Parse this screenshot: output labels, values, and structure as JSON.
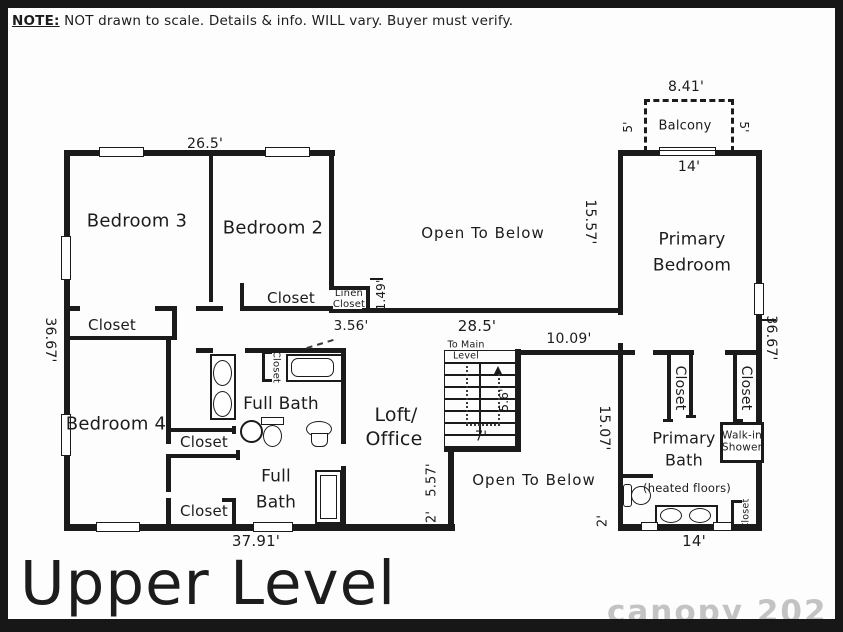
{
  "note": {
    "label": "NOTE:",
    "text": " NOT drawn to scale. Details & info. WILL vary. Buyer must verify."
  },
  "title": "Upper Level",
  "watermark": "canopy 202",
  "rooms": {
    "bedroom3": "Bedroom 3",
    "bedroom2": "Bedroom 2",
    "bedroom2_closet": "Closet",
    "linen_closet": "Linen Closet",
    "hall_closet": "Closet",
    "bedroom4": "Bedroom 4",
    "tub_closet": "Closet",
    "full_bath_upper": "Full Bath",
    "mid_closet": "Closet",
    "full_bath_lower": "Full Bath",
    "lower_closet": "Closet",
    "loft_line1": "Loft/",
    "loft_line2": "Office",
    "open_to_below_upper": "Open To Below",
    "open_to_below_lower": "Open To Below",
    "stairs_note": "To Main Level",
    "balcony": "Balcony",
    "primary_bedroom": "Primary Bedroom",
    "primary_closet_left": "Closet",
    "primary_closet_right": "Closet",
    "walk_in_shower": "Walk-in Shower",
    "primary_bath": "Primary Bath",
    "primary_bath_note": "(heated floors)",
    "primary_bath_closet": "Closet"
  },
  "dimensions": {
    "top_left_width": "26.5'",
    "balcony_width": "8.41'",
    "balcony_depth_left": "5'",
    "balcony_depth_right": "5'",
    "primary_top_width": "14'",
    "open_below_height": "15.57'",
    "linen_depth": "1.49'",
    "linen_width": "3.56'",
    "open_below_width": "28.5'",
    "hall_width": "10.09'",
    "left_height": "36.67'",
    "right_height": "36.67'",
    "stair_run": "5.6'",
    "stair_width": "7'",
    "open_lower_height": "15.07'",
    "loft_edge": "5.57'",
    "loft_stub": "2'",
    "primary_stub": "2'",
    "bottom_left_width": "37.91'",
    "bottom_right_width": "14'"
  }
}
